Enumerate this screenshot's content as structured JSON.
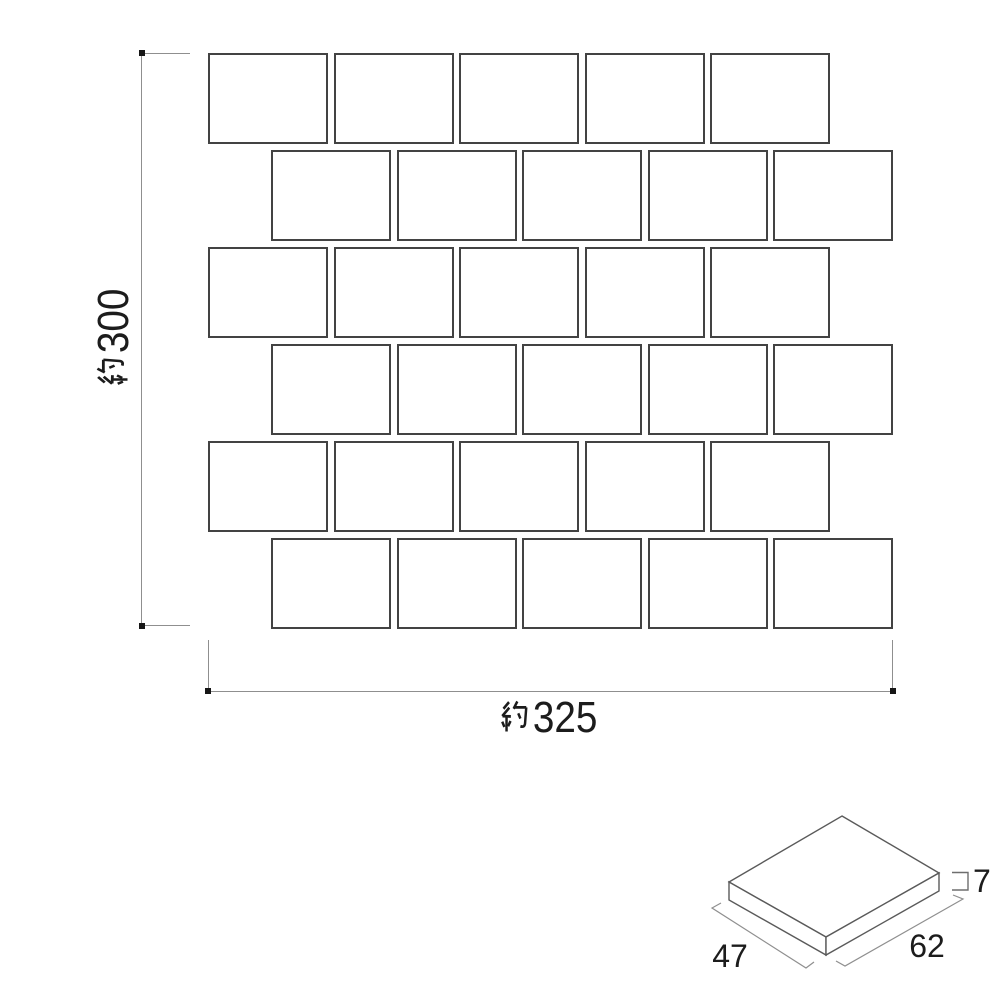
{
  "drawing": {
    "type": "tile-sheet-dimension-diagram",
    "sheet_pattern": {
      "rows": 6,
      "tiles_per_row": 5,
      "layout": "running-bond"
    },
    "dimensions": {
      "sheet_height": {
        "label": "約300",
        "prefix": "約",
        "value": "300"
      },
      "sheet_width": {
        "label": "約325",
        "prefix": "約",
        "value": "325"
      },
      "tile_depth": {
        "value": "47"
      },
      "tile_width": {
        "value": "62"
      },
      "tile_thickness": {
        "label": "□7",
        "value": "7"
      }
    },
    "colors": {
      "background": "#ffffff",
      "tile_border": "#434343",
      "dimension_line": "#8f8f8f",
      "text": "#1c1c1c"
    }
  }
}
